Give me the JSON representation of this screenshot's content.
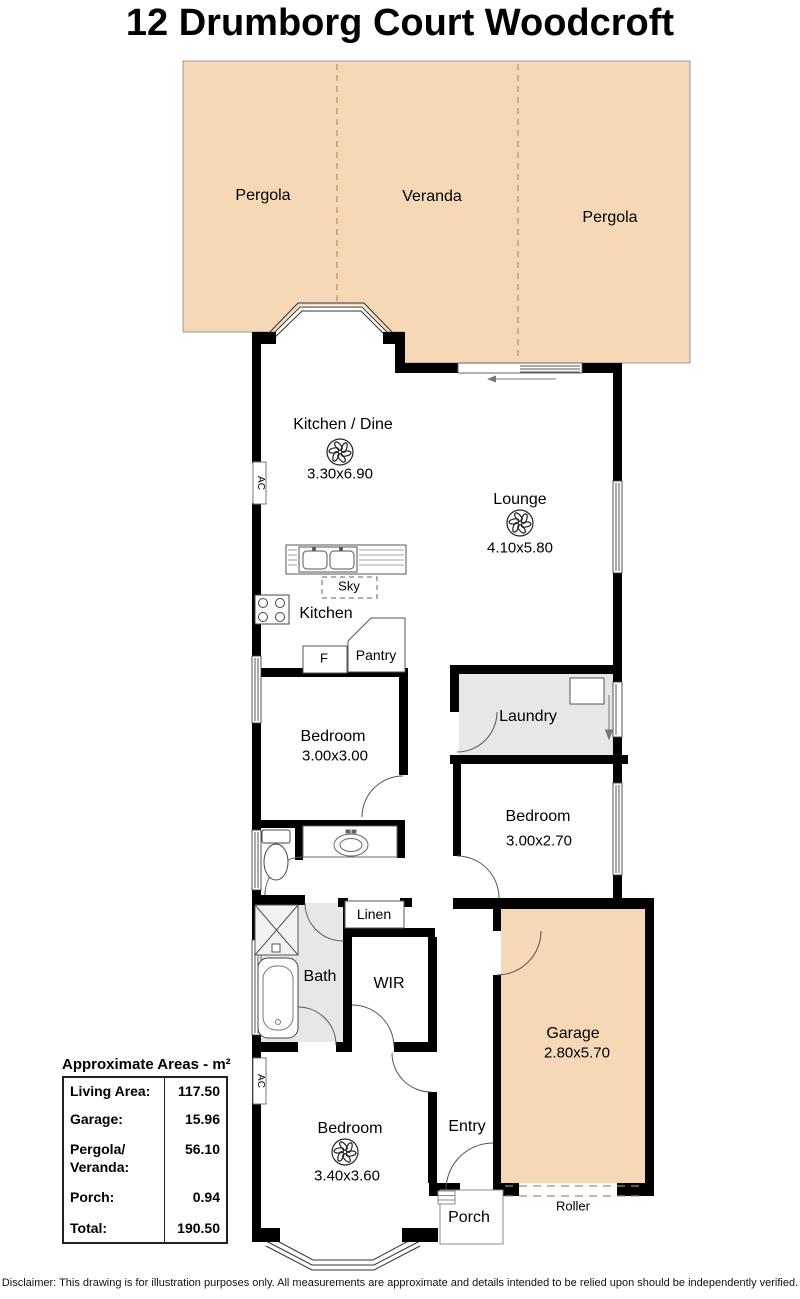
{
  "title": "12 Drumborg Court Woodcroft",
  "outdoor": {
    "pergola_left": "Pergola",
    "veranda": "Veranda",
    "pergola_right": "Pergola"
  },
  "rooms": {
    "kitchen_dine": {
      "name": "Kitchen / Dine",
      "dims": "3.30x6.90"
    },
    "lounge": {
      "name": "Lounge",
      "dims": "4.10x5.80"
    },
    "kitchen": "Kitchen",
    "sky": "Sky",
    "fridge": "F",
    "pantry": "Pantry",
    "bedroom_mid": {
      "name": "Bedroom",
      "dims": "3.00x3.00"
    },
    "laundry": "Laundry",
    "bedroom_rear": {
      "name": "Bedroom",
      "dims": "3.00x2.70"
    },
    "bath": "Bath",
    "wir": "WIR",
    "linen": "Linen",
    "garage": {
      "name": "Garage",
      "dims": "2.80x5.70"
    },
    "bedroom_front": {
      "name": "Bedroom",
      "dims": "3.40x3.60"
    },
    "entry": "Entry",
    "porch": "Porch",
    "roller": "Roller",
    "ac": "AC"
  },
  "areas": {
    "title": "Approximate Areas - m²",
    "rows": [
      {
        "label": "Living Area:",
        "value": "117.50"
      },
      {
        "label": "Garage:",
        "value": "15.96"
      },
      {
        "label": "Pergola/\nVeranda:",
        "value": "56.10"
      },
      {
        "label": "Porch:",
        "value": "0.94"
      },
      {
        "label": "Total:",
        "value": "190.50"
      }
    ]
  },
  "disclaimer": "Disclaimer: This drawing is for illustration purposes only. All measurements are approximate and details intended to be relied upon should be independently verified.",
  "colors": {
    "outdoor_fill": "#f6d8b7",
    "wet_fill": "#e7e7e7",
    "wall": "#000000"
  }
}
